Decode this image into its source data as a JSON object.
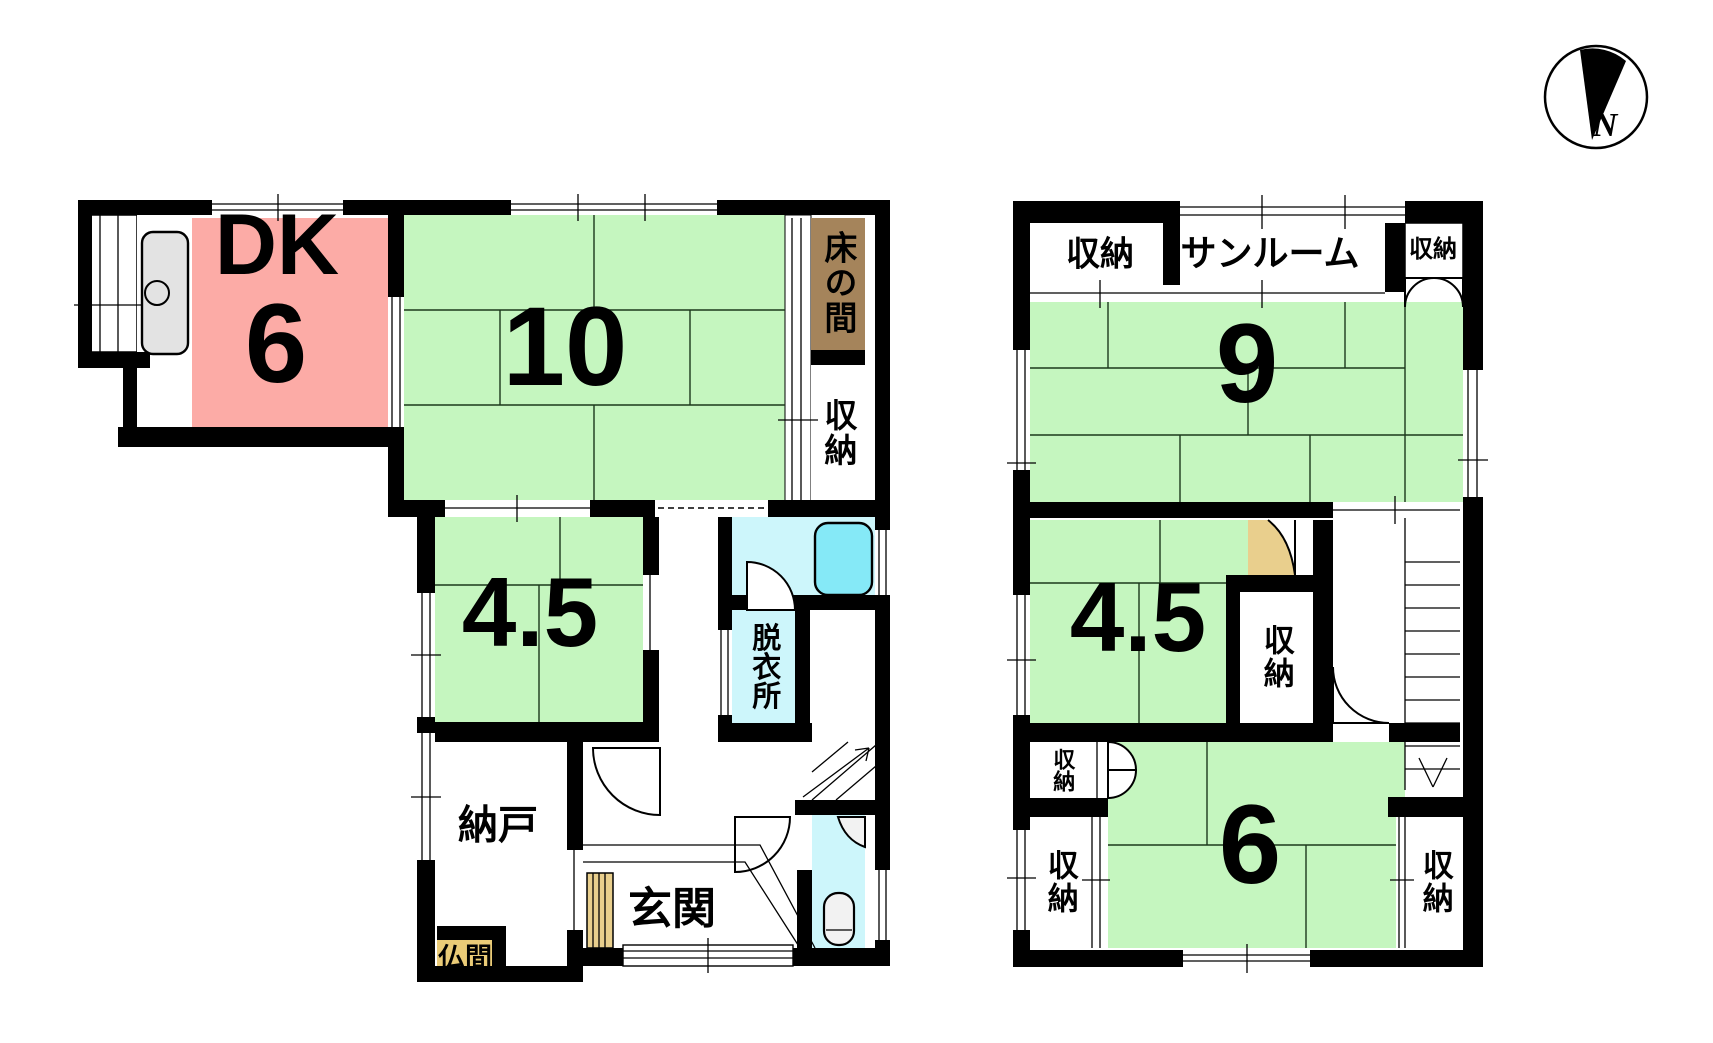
{
  "colors": {
    "tatami_green": "#c5f6bf",
    "dk_pink": "#fcaba6",
    "tokonoma_brown": "#a5845b",
    "butsuma_tan": "#eacb77",
    "step_tan": "#e9cf8d",
    "wet_area_cyan": "#cdf6fb",
    "bathtub_cyan": "#85e9f7",
    "wall_black": "#000000"
  },
  "floor1": {
    "dk": {
      "name": "DK",
      "size": "6"
    },
    "washitsu10": {
      "size": "10"
    },
    "tokonoma": {
      "label": "床の間"
    },
    "shuno": {
      "label": "収納"
    },
    "washitsu45": {
      "size": "4.5"
    },
    "datsuijo": {
      "label": "脱衣所"
    },
    "nando": {
      "label": "納戸"
    },
    "butsuma": {
      "label": "仏間"
    },
    "genkan": {
      "label": "玄関"
    }
  },
  "floor2": {
    "shuno_top_left": {
      "label": "収納"
    },
    "sunroom": {
      "label": "サンルーム"
    },
    "shuno_top_right": {
      "label": "収納"
    },
    "washitsu9": {
      "size": "9"
    },
    "washitsu45": {
      "size": "4.5"
    },
    "shuno_mid": {
      "label": "収納"
    },
    "shuno_bottom_left_small": {
      "label": "収納"
    },
    "shuno_bottom_left": {
      "label": "収納"
    },
    "washitsu6": {
      "size": "6"
    },
    "shuno_bottom_right": {
      "label": "収納"
    }
  },
  "compass": {
    "north_label": "N"
  }
}
